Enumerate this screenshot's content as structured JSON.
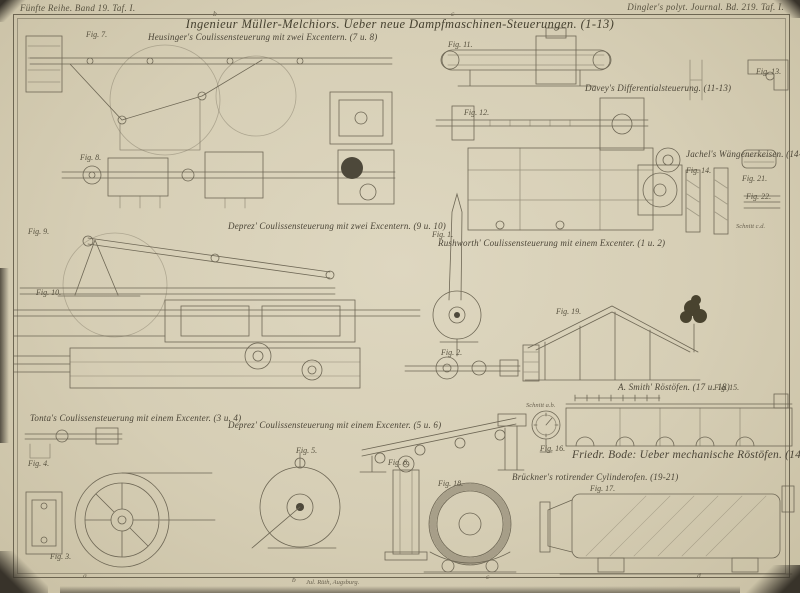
{
  "plate": {
    "header_left": "Fünfte Reihe. Band 19. Taf. I.",
    "header_right": "Dingler's polyt. Journal. Bd. 219. Taf. I.",
    "title": "Ingenieur Müller-Melchiors. Ueber neue Dampfmaschinen-Steuerungen. (1-13)",
    "printer_mark": "Jul. Rüth, Augsburg."
  },
  "captions": [
    {
      "text": "Heusinger's Coulissensteuerung mit zwei Excentern. (7 u. 8)"
    },
    {
      "text": "Deprez' Coulissensteuerung mit zwei Excentern. (9 u. 10)"
    },
    {
      "text": "Davey's Differentialsteuerung. (11-13)"
    },
    {
      "text": "Rushworth' Coulissensteuerung mit einem Excenter. (1 u. 2)"
    },
    {
      "text": "Tonta's Coulissensteuerung mit einem Excenter. (3 u. 4)"
    },
    {
      "text": "Deprez' Coulissensteuerung mit einem Excenter. (5 u. 6)"
    },
    {
      "text": "Jachel's Wängenerkeisen. (14-16)"
    },
    {
      "text": "A. Smith' Röstöfen. (17 u. 18)"
    },
    {
      "text": "Friedr. Bode: Ueber mechanische Röstöfen. (14-21)"
    },
    {
      "text": "Brückner's rotirender Cylinderofen. (19-21)"
    }
  ],
  "fig_labels": [
    "Fig. 7.",
    "Fig. 8.",
    "Fig. 9.",
    "Fig. 10.",
    "Fig. 11.",
    "Fig. 12.",
    "Fig. 13.",
    "Fig. 1.",
    "Fig. 2.",
    "Fig. 4.",
    "Fig. 3.",
    "Fig. 5.",
    "Fig. 6.",
    "Fig. 19.",
    "Fig. 14.",
    "Fig. 21.",
    "Fig. 22.",
    "Fig. 15.",
    "Fig. 16.",
    "Fig. 17.",
    "Fig. 18."
  ],
  "section_labels": [
    "Schnitt a.b.",
    "Schnitt c.d."
  ],
  "border_markers": {
    "top": [
      "b",
      "c"
    ],
    "bottom": [
      "a",
      "b",
      "c",
      "d"
    ]
  },
  "colors": {
    "paper": "#d6ceb5",
    "ink": "#4b4537",
    "line": "#6e6755",
    "shadow": "#3a352a"
  }
}
